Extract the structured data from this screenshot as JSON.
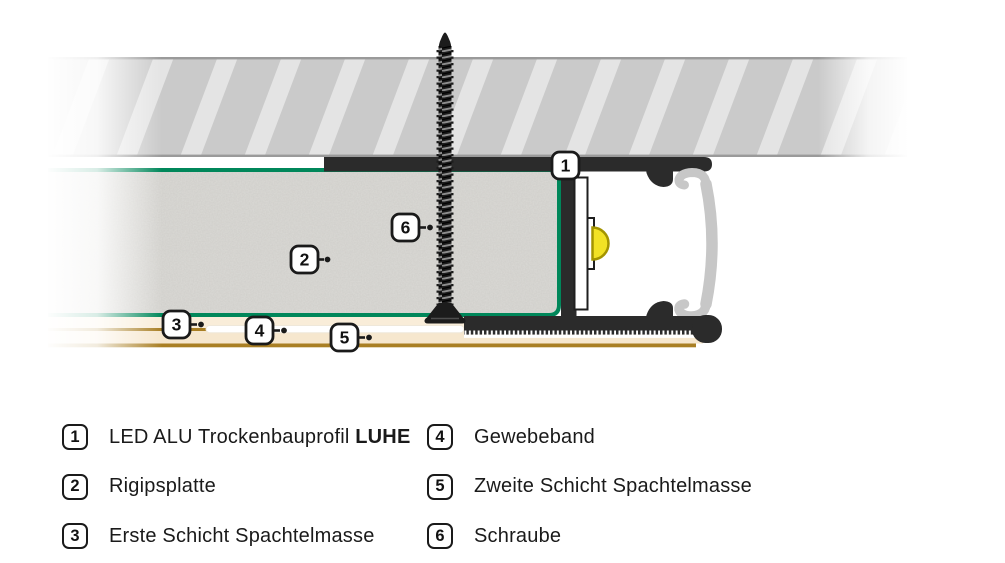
{
  "diagram": {
    "callouts": [
      {
        "number": "1"
      },
      {
        "number": "2"
      },
      {
        "number": "3"
      },
      {
        "number": "4"
      },
      {
        "number": "5"
      },
      {
        "number": "6"
      }
    ]
  },
  "colors": {
    "board_edge_green": "#00875A",
    "led_yellow": "#F2E225",
    "led_dome_rim": "#A39400",
    "profile_dark": "#2B2B2B",
    "diffuser_gray": "#C7C7C7",
    "hatch_base": "#CACACA",
    "hatch_stripe": "#E4E4E4",
    "hatch_border": "#9A9A9A",
    "spachtel_cream": "#F9EDD9",
    "gold_line": "#A97F24",
    "text_black": "#1A1A1A"
  },
  "legend": {
    "columns": [
      {
        "items": [
          {
            "number": "1",
            "label": "LED ALU Trockenbauprofil ",
            "label_bold": "LUHE"
          },
          {
            "number": "2",
            "label": "Rigipsplatte"
          },
          {
            "number": "3",
            "label": "Erste Schicht Spachtelmasse"
          }
        ]
      },
      {
        "items": [
          {
            "number": "4",
            "label": "Gewebeband"
          },
          {
            "number": "5",
            "label": "Zweite Schicht Spachtelmasse"
          },
          {
            "number": "6",
            "label": "Schraube"
          }
        ]
      }
    ]
  }
}
